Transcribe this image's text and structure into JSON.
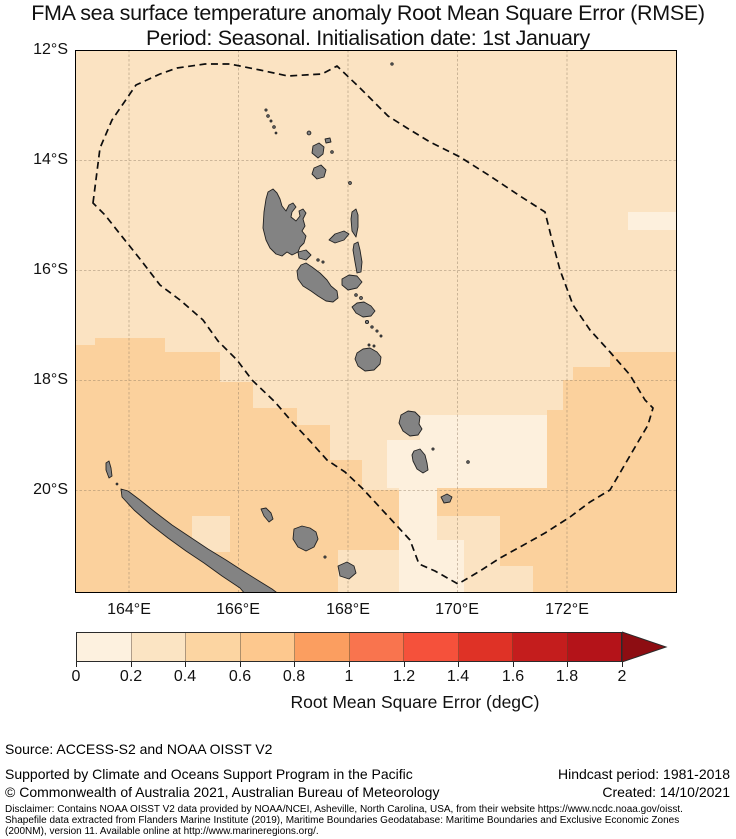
{
  "title": {
    "line1": "FMA sea surface temperature anomaly Root Mean Square Error (RMSE)",
    "line2": "Period: Seasonal. Initialisation date: 1st January"
  },
  "map": {
    "lat_ticks": [
      "12°S",
      "14°S",
      "16°S",
      "18°S",
      "20°S"
    ],
    "lon_ticks": [
      "164°E",
      "166°E",
      "168°E",
      "170°E",
      "172°E"
    ],
    "colors": {
      "rmse_0_02": "#fdf0dd",
      "rmse_02_04": "#fbe3c2",
      "rmse_04_06": "#fbd19d",
      "land": "#838383",
      "coastline": "#222222",
      "eez_boundary": "#0d0d0d",
      "gridline": "#8c7860"
    }
  },
  "colorbar": {
    "tick_labels": [
      "0",
      "0.2",
      "0.4",
      "0.6",
      "0.8",
      "1",
      "1.2",
      "1.4",
      "1.6",
      "1.8",
      "2"
    ],
    "label": "Root Mean Square Error (degC)",
    "segment_colors": [
      "#fdf1df",
      "#fbe4c3",
      "#fcd5a2",
      "#fdc88e",
      "#fb9e60",
      "#f9744e",
      "#f5513b",
      "#df3226",
      "#c41d1d",
      "#b41319"
    ],
    "arrow_color": "#8d0d12"
  },
  "footer": {
    "source": "Source: ACCESS-S2 and NOAA OISST V2",
    "supported": "Supported by Climate and Oceans Support Program in the Pacific",
    "copyright": "© Commonwealth of Australia 2021, Australian Bureau of Meteorology",
    "hindcast": "Hindcast period: 1981-2018",
    "created": "Created: 14/10/2021",
    "disclaimer_line1": "Disclaimer: Contains NOAA OISST V2 data provided by NOAA/NCEI, Asheville, North Carolina, USA, from their website https://www.ncdc.noaa.gov/oisst.",
    "disclaimer_line2": "Shapefile data extracted from Flanders Marine Institute (2019), Maritime Boundaries Geodatabase: Maritime Boundaries and Exclusive Economic Zones",
    "disclaimer_line3": "(200NM), version 11. Available online at http://www.marineregions.org/."
  }
}
